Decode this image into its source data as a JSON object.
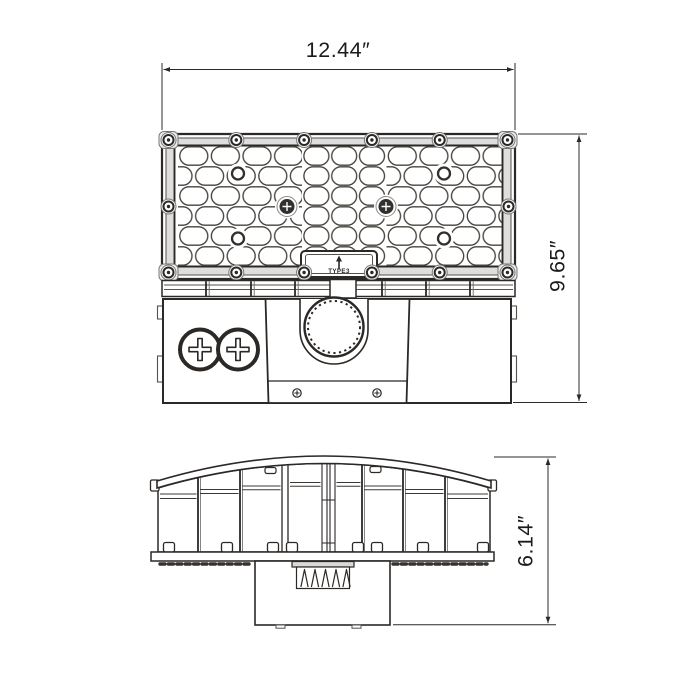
{
  "drawing": {
    "views": {
      "top_view": {
        "width_dim": "12.44″",
        "height_dim": "9.65″",
        "lens_tag": "TYPE3"
      },
      "side_view": {
        "height_dim": "6.14″"
      }
    },
    "dimensions_in": {
      "width": 12.44,
      "height": 9.65,
      "depth": 6.14
    },
    "colors": {
      "line": "#2b2826",
      "line_light": "#6e6a66",
      "background": "#ffffff",
      "frame_band_fill": "#dedede"
    }
  }
}
